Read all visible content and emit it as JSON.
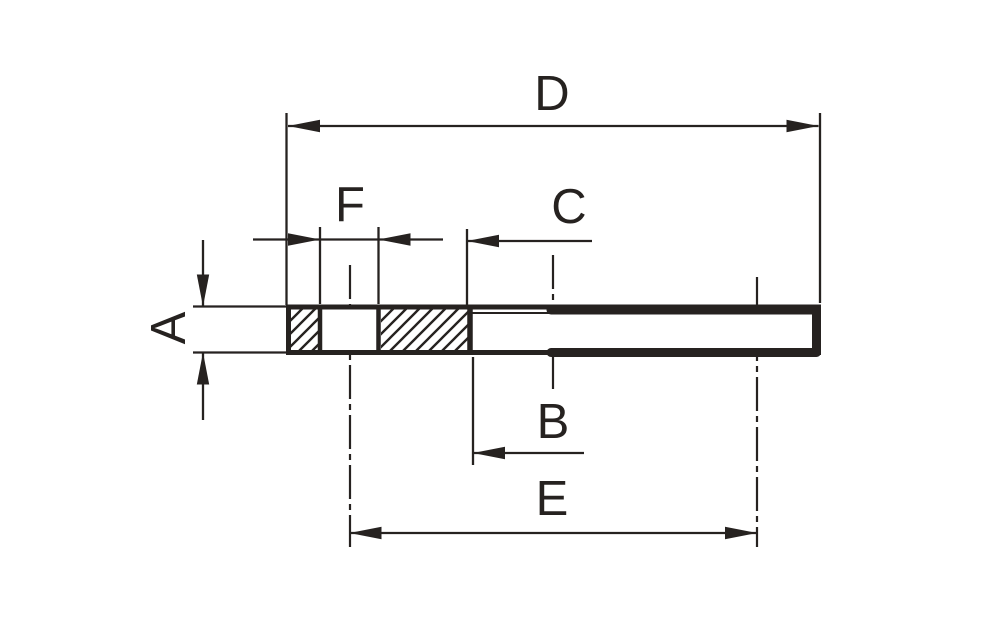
{
  "drawing": {
    "title": "flange-cross-section-dimension-drawing",
    "background_color": "#ffffff",
    "ink_color": "#262220",
    "labels": {
      "a": "A",
      "b": "B",
      "c": "C",
      "d": "D",
      "e": "E",
      "f": "F"
    }
  }
}
